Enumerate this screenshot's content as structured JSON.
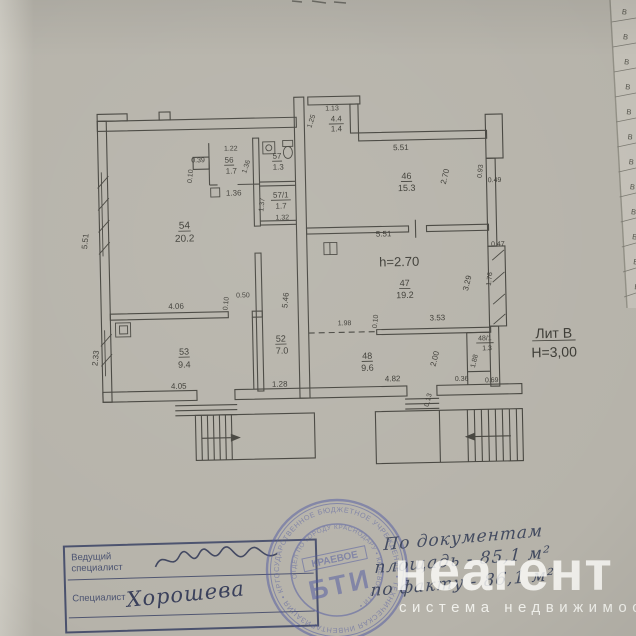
{
  "plan": {
    "labels": [
      {
        "t": "5.51",
        "x": 89,
        "y": 237,
        "r": -83
      },
      {
        "t": "2.33",
        "x": 97,
        "y": 354,
        "r": -83
      },
      {
        "t": "0.39",
        "x": 201,
        "y": 160,
        "s": 7
      },
      {
        "t": "0.10",
        "x": 195,
        "y": 174,
        "r": -83,
        "s": 7
      },
      {
        "t": "1.22",
        "x": 234,
        "y": 149,
        "s": 7
      },
      {
        "t": "56",
        "x": 232,
        "y": 161,
        "u": 1
      },
      {
        "t": "1.7",
        "x": 234,
        "y": 172
      },
      {
        "t": "1.36",
        "x": 251,
        "y": 166,
        "r": -70,
        "s": 7
      },
      {
        "t": "57",
        "x": 280,
        "y": 158,
        "u": 1
      },
      {
        "t": "1.3",
        "x": 281,
        "y": 169
      },
      {
        "t": "57/1",
        "x": 283,
        "y": 197,
        "u": 1
      },
      {
        "t": "1.7",
        "x": 283,
        "y": 208
      },
      {
        "t": "1.32",
        "x": 284,
        "y": 219,
        "s": 7
      },
      {
        "t": "1.37",
        "x": 266,
        "y": 204,
        "r": -83,
        "s": 7
      },
      {
        "t": "1.36",
        "x": 236,
        "y": 194
      },
      {
        "t": "54",
        "x": 186,
        "y": 226,
        "u": 1,
        "s": 10
      },
      {
        "t": "20.2",
        "x": 186,
        "y": 239,
        "s": 10
      },
      {
        "t": "4.06",
        "x": 176,
        "y": 306
      },
      {
        "t": "0.50",
        "x": 243,
        "y": 296,
        "s": 7
      },
      {
        "t": "0.10",
        "x": 228,
        "y": 302,
        "r": -83,
        "s": 7
      },
      {
        "t": "53",
        "x": 183,
        "y": 352,
        "u": 1,
        "s": 9
      },
      {
        "t": "9.4",
        "x": 183,
        "y": 365,
        "s": 9
      },
      {
        "t": "4.05",
        "x": 177,
        "y": 386
      },
      {
        "t": "52",
        "x": 280,
        "y": 341,
        "u": 1,
        "s": 9
      },
      {
        "t": "7.0",
        "x": 281,
        "y": 353,
        "s": 9
      },
      {
        "t": "5.46",
        "x": 288,
        "y": 300,
        "r": -83
      },
      {
        "t": "1.28",
        "x": 278,
        "y": 386
      },
      {
        "t": "1.13",
        "x": 336,
        "y": 111,
        "s": 7
      },
      {
        "t": "4.4",
        "x": 340,
        "y": 122,
        "u": 1
      },
      {
        "t": "1.4",
        "x": 340,
        "y": 132
      },
      {
        "t": "1.25",
        "x": 317,
        "y": 122,
        "r": -70,
        "s": 7
      },
      {
        "t": "5.51",
        "x": 404,
        "y": 152
      },
      {
        "t": "46",
        "x": 409,
        "y": 181,
        "u": 1,
        "s": 9
      },
      {
        "t": "15.3",
        "x": 409,
        "y": 193,
        "s": 9
      },
      {
        "t": "2.70",
        "x": 450,
        "y": 180,
        "r": -75
      },
      {
        "t": "0.93",
        "x": 485,
        "y": 175,
        "r": -83,
        "s": 7
      },
      {
        "t": "0.49",
        "x": 497,
        "y": 186,
        "s": 7
      },
      {
        "t": "5.51",
        "x": 385,
        "y": 238
      },
      {
        "t": "0.47",
        "x": 499,
        "y": 250,
        "s": 7
      },
      {
        "t": "h=2.70",
        "x": 400,
        "y": 268,
        "s": 13
      },
      {
        "t": "47",
        "x": 405,
        "y": 288,
        "u": 1,
        "s": 9
      },
      {
        "t": "19.2",
        "x": 405,
        "y": 300,
        "s": 9
      },
      {
        "t": "3.29",
        "x": 470,
        "y": 287,
        "r": -75
      },
      {
        "t": "1.76",
        "x": 492,
        "y": 283,
        "r": -83,
        "s": 7
      },
      {
        "t": "1.98",
        "x": 344,
        "y": 326,
        "s": 7
      },
      {
        "t": "0.10",
        "x": 377,
        "y": 323,
        "r": -83,
        "s": 7
      },
      {
        "t": "3.53",
        "x": 437,
        "y": 323
      },
      {
        "t": "48",
        "x": 366,
        "y": 360,
        "u": 1,
        "s": 9
      },
      {
        "t": "9.6",
        "x": 366,
        "y": 372,
        "s": 9
      },
      {
        "t": "2.00",
        "x": 436,
        "y": 362,
        "r": -75
      },
      {
        "t": "4.82",
        "x": 391,
        "y": 383
      },
      {
        "t": "48/1",
        "x": 484,
        "y": 344,
        "u": 1,
        "s": 7
      },
      {
        "t": "1.3",
        "x": 486,
        "y": 354,
        "s": 7
      },
      {
        "t": "1.88",
        "x": 475,
        "y": 365,
        "r": -75,
        "s": 7
      },
      {
        "t": "0.36",
        "x": 460,
        "y": 384,
        "s": 7
      },
      {
        "t": "0.69",
        "x": 490,
        "y": 386,
        "s": 7
      },
      {
        "t": "0.13",
        "x": 428,
        "y": 403,
        "r": -75,
        "s": 7
      },
      {
        "t": "Лит В",
        "x": 553,
        "y": 343,
        "s": 14,
        "u": 1
      },
      {
        "t": "Н=3,00",
        "x": 553,
        "y": 362,
        "s": 14
      }
    ]
  },
  "stamp": {
    "ring_text": "ГОСУДАРСТВЕННОЕ БЮДЖЕТНОЕ УЧРЕЖДЕНИЕ • ТЕХНИЧЕСКАЯ ИНВЕНТАРИЗАЦИЯ • КРАСНОДАРСКОГО КРАЯ •",
    "inner_ring_text": "ОТДЕЛ ПО ГОРОДУ КРАСНОДАРУ • КРАЕВОЕ БТИ •",
    "center_top": "КРАЕВОЕ",
    "center_main": "БТИ"
  },
  "signature_block": {
    "row1_label": "Ведущий специалист",
    "row2_label": "Специалист",
    "row2_name": "Хорошева"
  },
  "handwriting": {
    "line1": "По документам",
    "line2": "площадь - 85,1 м²",
    "line3": "по факту - 86,1 м²"
  },
  "watermark": {
    "brand": "неагент",
    "tagline": "система недвижимости"
  },
  "side_strip": {
    "letters": [
      "В",
      "В",
      "В",
      "В",
      "В",
      "В",
      "В",
      "В",
      "В",
      "В",
      "В",
      "В"
    ]
  }
}
